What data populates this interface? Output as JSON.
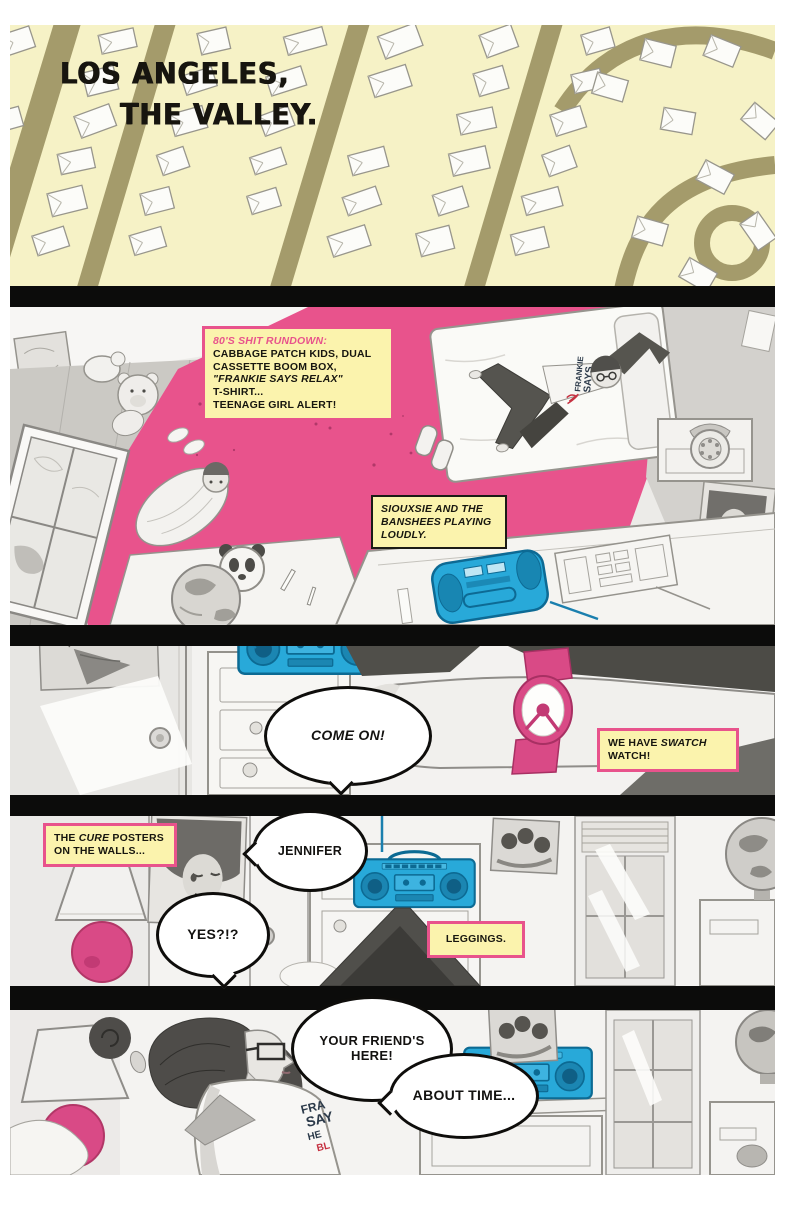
{
  "colors": {
    "pink_accent": "#e8538c",
    "caption_yellow": "#fbf3ad",
    "boombox_blue": "#28a9d9",
    "map_yellow": "#f6f2c6",
    "road_olive": "#a49b6b",
    "gutter_black": "#0c0c0b",
    "watch_pink": "#d94a86"
  },
  "panel_1": {
    "title_line_1": "LOS ANGELES,",
    "title_line_2": "THE VALLEY."
  },
  "panel_2": {
    "rundown_caption": {
      "heading": "80'S SHIT RUNDOWN:",
      "lines": [
        "CABBAGE PATCH KIDS, DUAL",
        "CASSETTE BOOM BOX,",
        "\"FRANKIE SAYS RELAX\"",
        "T-SHIRT...",
        "TEENAGE GIRL ALERT!"
      ]
    },
    "music_caption": "SIOUXSIE AND THE BANSHEES PLAYING LOUDLY.",
    "shirt_lines": [
      "FRANKIE",
      "SAYS"
    ]
  },
  "panel_3": {
    "speech_bubble": "COME ON!",
    "caption": {
      "pre": "WE HAVE ",
      "brand": "SWATCH",
      "post": " WATCH!"
    }
  },
  "panel_4": {
    "posters_caption": {
      "pre": "THE ",
      "band": "CURE",
      "post": " POSTERS ON THE WALLS..."
    },
    "speech_bubble_jennifer": "JENNIFER",
    "speech_bubble_yes": "YES?!?",
    "leggings_caption": "LEGGINGS."
  },
  "panel_5": {
    "speech_bubble_friend": "YOUR FRIEND'S HERE!",
    "speech_bubble_about_time": "ABOUT TIME...",
    "shirt_lines": [
      "FRA",
      "SAY",
      "HE"
    ],
    "shirt_red": "BL"
  }
}
